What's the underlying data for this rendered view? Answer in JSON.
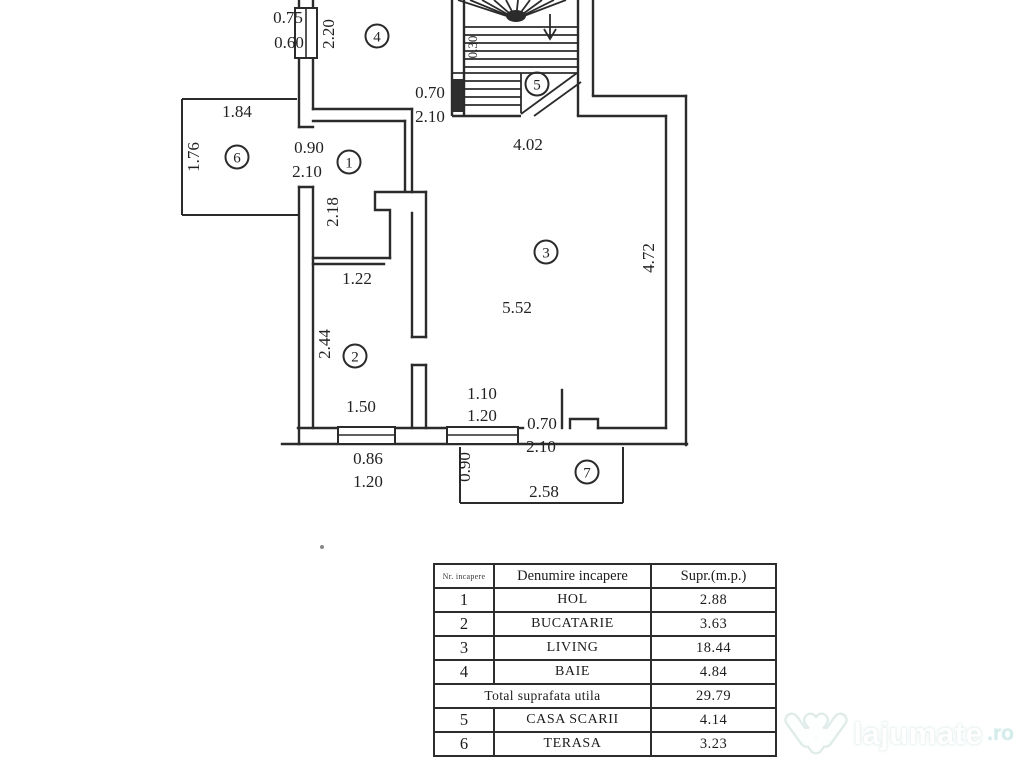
{
  "plan": {
    "line_color": "#2b2b2b",
    "labels": [
      {
        "t": "0.75",
        "x": 288,
        "y": 23
      },
      {
        "t": "0.60",
        "x": 289,
        "y": 48
      },
      {
        "t": "2.20",
        "x": 334,
        "y": 34,
        "rot": true
      },
      {
        "t": "0.70",
        "x": 430,
        "y": 98
      },
      {
        "t": "2.10",
        "x": 430,
        "y": 122
      },
      {
        "t": "0.30",
        "x": 477,
        "y": 47,
        "rot": true,
        "size": 13
      },
      {
        "t": "4.02",
        "x": 528,
        "y": 150
      },
      {
        "t": "1.84",
        "x": 237,
        "y": 117
      },
      {
        "t": "1.76",
        "x": 199,
        "y": 157,
        "rot": true
      },
      {
        "t": "0.90",
        "x": 309,
        "y": 153
      },
      {
        "t": "2.10",
        "x": 307,
        "y": 177
      },
      {
        "t": "2.18",
        "x": 338,
        "y": 212,
        "rot": true
      },
      {
        "t": "1.22",
        "x": 357,
        "y": 284
      },
      {
        "t": "2.44",
        "x": 330,
        "y": 344,
        "rot": true
      },
      {
        "t": "5.52",
        "x": 517,
        "y": 313
      },
      {
        "t": "4.72",
        "x": 654,
        "y": 258,
        "rot": true
      },
      {
        "t": "1.50",
        "x": 361,
        "y": 412
      },
      {
        "t": "1.10",
        "x": 482,
        "y": 399
      },
      {
        "t": "1.20",
        "x": 482,
        "y": 421
      },
      {
        "t": "0.86",
        "x": 368,
        "y": 464
      },
      {
        "t": "1.20",
        "x": 368,
        "y": 487
      },
      {
        "t": "0.90",
        "x": 470,
        "y": 467,
        "rot": true
      },
      {
        "t": "0.70",
        "x": 542,
        "y": 429
      },
      {
        "t": "2.10",
        "x": 541,
        "y": 452
      },
      {
        "t": "2.58",
        "x": 544,
        "y": 497
      }
    ],
    "rooms": [
      {
        "n": "1",
        "x": 349,
        "y": 162
      },
      {
        "n": "2",
        "x": 355,
        "y": 356
      },
      {
        "n": "3",
        "x": 546,
        "y": 252
      },
      {
        "n": "4",
        "x": 377,
        "y": 36
      },
      {
        "n": "5",
        "x": 537,
        "y": 84
      },
      {
        "n": "6",
        "x": 237,
        "y": 157
      },
      {
        "n": "7",
        "x": 587,
        "y": 472
      }
    ]
  },
  "table": {
    "headers": {
      "nr": "Nr. incapere",
      "name": "Denumire incapere",
      "area": "Supr.(m.p.)"
    },
    "rows": [
      {
        "nr": "1",
        "name": "HOL",
        "area": "2.88"
      },
      {
        "nr": "2",
        "name": "BUCATARIE",
        "area": "3.63"
      },
      {
        "nr": "3",
        "name": "LIVING",
        "area": "18.44"
      },
      {
        "nr": "4",
        "name": "BAIE",
        "area": "4.84"
      },
      {
        "total": true,
        "name": "Total suprafata utila",
        "area": "29.79"
      },
      {
        "nr": "5",
        "name": "CASA SCARII",
        "area": "4.14"
      },
      {
        "nr": "6",
        "name": "TERASA",
        "area": "3.23"
      }
    ]
  },
  "watermark": {
    "brand": "lajumate",
    "tld": ".ro"
  }
}
